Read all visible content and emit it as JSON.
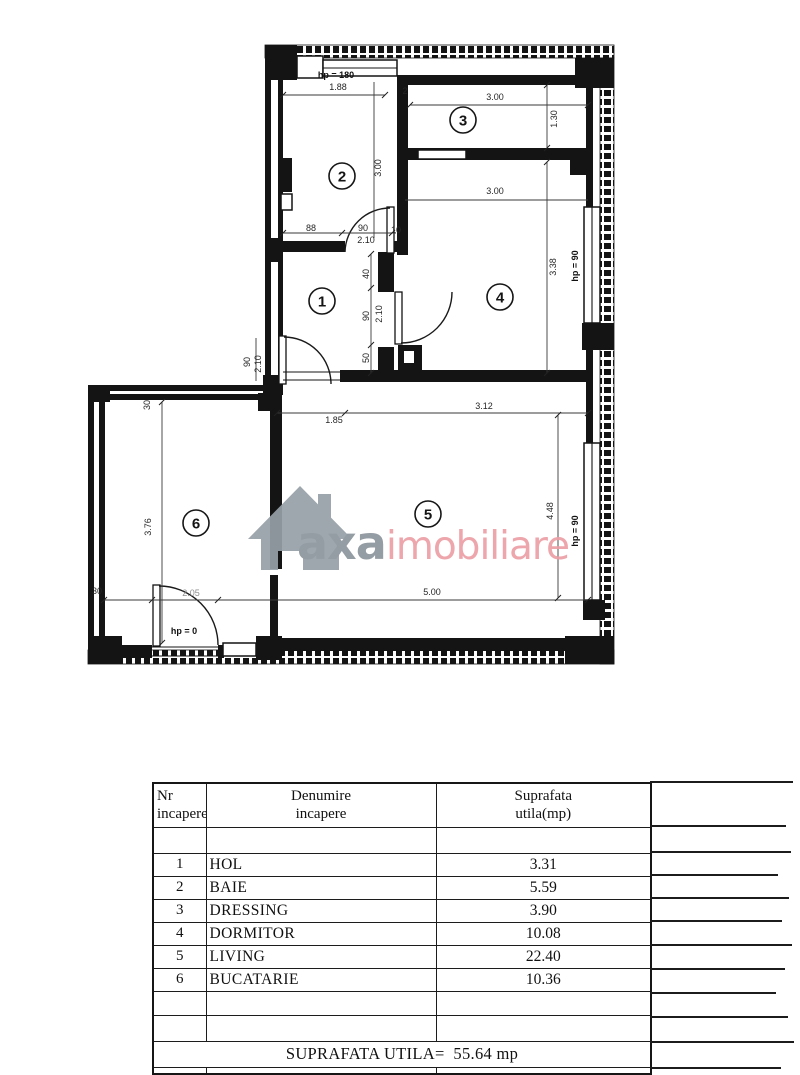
{
  "watermark": {
    "brand": "axa",
    "suffix": "imobiliare",
    "gray_color": "#8d959d",
    "pink_color": "#ec9fa6",
    "house_icon_color": "#97a0a8"
  },
  "plan": {
    "rooms": [
      {
        "n": "1",
        "x": 322,
        "y": 301
      },
      {
        "n": "2",
        "x": 342,
        "y": 176
      },
      {
        "n": "3",
        "x": 463,
        "y": 120
      },
      {
        "n": "4",
        "x": 500,
        "y": 297
      },
      {
        "n": "5",
        "x": 428,
        "y": 514
      },
      {
        "n": "6",
        "x": 196,
        "y": 523
      }
    ],
    "labels": [
      {
        "t": "hp = 180",
        "x": 336,
        "y": 78,
        "b": 1,
        "s": 10.5
      },
      {
        "t": "1.88",
        "x": 338,
        "y": 90,
        "s": 9
      },
      {
        "t": "2",
        "x": 405,
        "y": 94,
        "s": 8
      },
      {
        "t": "3.00",
        "x": 495,
        "y": 100,
        "s": 9
      },
      {
        "t": "1.30",
        "x": 557,
        "y": 119,
        "r": -90,
        "s": 8.5
      },
      {
        "t": "3.00",
        "x": 381,
        "y": 168,
        "r": -90,
        "s": 9
      },
      {
        "t": "3.00",
        "x": 495,
        "y": 194,
        "s": 9
      },
      {
        "t": "3.38",
        "x": 556,
        "y": 267,
        "r": -90,
        "s": 8.5
      },
      {
        "t": "hp = 90",
        "x": 578,
        "y": 266,
        "r": -90,
        "b": 1,
        "s": 10
      },
      {
        "t": "88",
        "x": 311,
        "y": 231,
        "s": 8
      },
      {
        "t": "90",
        "x": 363,
        "y": 231,
        "s": 8
      },
      {
        "t": "2.10",
        "x": 366,
        "y": 243,
        "s": 8
      },
      {
        "t": "10",
        "x": 396,
        "y": 233,
        "s": 7.5
      },
      {
        "t": "40",
        "x": 369,
        "y": 274,
        "r": -90,
        "s": 8
      },
      {
        "t": "90",
        "x": 369,
        "y": 316,
        "r": -90,
        "s": 8
      },
      {
        "t": "2.10",
        "x": 382,
        "y": 314,
        "r": -90,
        "s": 8
      },
      {
        "t": "50",
        "x": 369,
        "y": 358,
        "r": -90,
        "s": 8
      },
      {
        "t": "90",
        "x": 250,
        "y": 362,
        "r": -90,
        "s": 8
      },
      {
        "t": "2.10",
        "x": 261,
        "y": 364,
        "r": -90,
        "s": 8
      },
      {
        "t": "1.85",
        "x": 334,
        "y": 423,
        "s": 9
      },
      {
        "t": "3.12",
        "x": 484,
        "y": 409,
        "s": 9
      },
      {
        "t": "4.48",
        "x": 553,
        "y": 511,
        "r": -90,
        "s": 8.5
      },
      {
        "t": "hp = 90",
        "x": 578,
        "y": 531,
        "r": -90,
        "b": 1,
        "s": 10
      },
      {
        "t": "5.00",
        "x": 432,
        "y": 595,
        "s": 9
      },
      {
        "t": "2.05",
        "x": 191,
        "y": 596,
        "s": 7.5,
        "f": 1
      },
      {
        "t": "hp = 0",
        "x": 184,
        "y": 634,
        "b": 1,
        "s": 10
      },
      {
        "t": "3.76",
        "x": 151,
        "y": 527,
        "r": -90,
        "s": 8.5
      },
      {
        "t": "30",
        "x": 150,
        "y": 405,
        "r": -90,
        "s": 7.5
      },
      {
        "t": "30",
        "x": 97,
        "y": 594,
        "s": 7.5
      }
    ]
  },
  "table": {
    "headers": [
      {
        "line1": "Nr",
        "line2": "incapere"
      },
      {
        "line1": "Denumire",
        "line2": "incapere"
      },
      {
        "line1": "Suprafata",
        "line2": "utila(mp)"
      }
    ],
    "rows": [
      {
        "nr": "1",
        "name": "HOL",
        "area": "3.31"
      },
      {
        "nr": "2",
        "name": "BAIE",
        "area": "5.59"
      },
      {
        "nr": "3",
        "name": "DRESSING",
        "area": "3.90"
      },
      {
        "nr": "4",
        "name": "DORMITOR",
        "area": "10.08"
      },
      {
        "nr": "5",
        "name": "LIVING",
        "area": "22.40"
      },
      {
        "nr": "6",
        "name": "BUCATARIE",
        "area": "10.36"
      }
    ],
    "total": {
      "label": "SUPRAFATA UTILA=",
      "value": "55.64 mp"
    }
  }
}
